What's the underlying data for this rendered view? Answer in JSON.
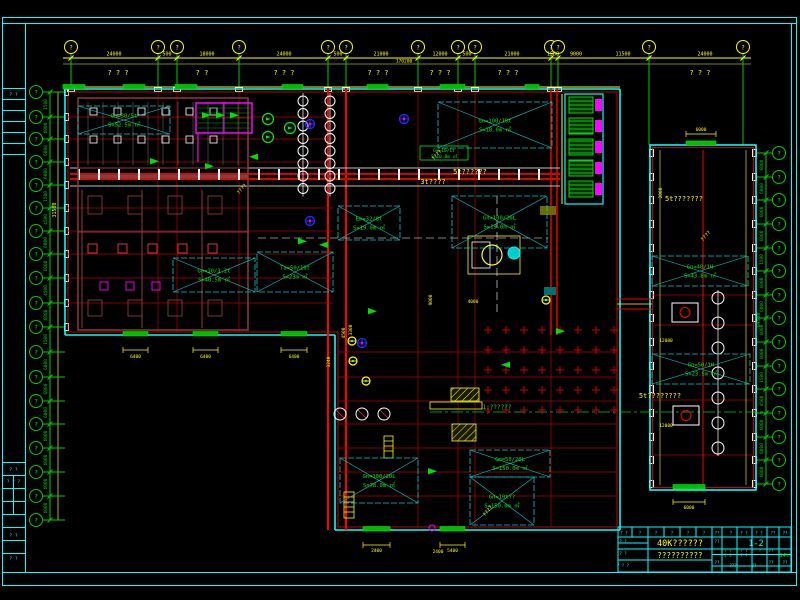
{
  "drawing": {
    "colors": {
      "frame": "#00FFFF",
      "grid_bubble": "#00CC00",
      "dim": "#FFFF00",
      "wall": "#00FFFF",
      "grid_line": "#B00000",
      "axis_green": "#00CC00",
      "equipment_maroon": "#8A3B3B",
      "stair": "#FF00FF",
      "door": "#00BB00",
      "label_green": "#00EE00",
      "label_yellow": "#FFFF00",
      "machine_white": "#FFFFFF",
      "pump_blue": "#2A2AFF"
    },
    "top_axis": {
      "bubble_label": "?",
      "bubbles": [
        {
          "x": 71
        },
        {
          "x": 158
        },
        {
          "x": 177
        },
        {
          "x": 239
        },
        {
          "x": 328
        },
        {
          "x": 346
        },
        {
          "x": 418
        },
        {
          "x": 458
        },
        {
          "x": 475
        },
        {
          "x": 551
        },
        {
          "x": 558
        },
        {
          "x": 649,
          "drop": 145
        },
        {
          "x": 743,
          "drop": 145
        }
      ],
      "dims": [
        {
          "x": 114,
          "t": "24000"
        },
        {
          "x": 167,
          "t": "500"
        },
        {
          "x": 207,
          "t": "18000"
        },
        {
          "x": 284,
          "t": "24000"
        },
        {
          "x": 338,
          "t": "500"
        },
        {
          "x": 381,
          "t": "21000"
        },
        {
          "x": 440,
          "t": "12000"
        },
        {
          "x": 467,
          "t": "500"
        },
        {
          "x": 512,
          "t": "21000"
        },
        {
          "x": 553,
          "t": "1500"
        },
        {
          "x": 576,
          "t": "9000"
        },
        {
          "x": 623,
          "t": "11500"
        },
        {
          "x": 705,
          "t": "24000"
        }
      ],
      "total": {
        "x": 404,
        "t": "170200"
      },
      "notes": [
        {
          "x": 118,
          "t": "? ? ?"
        },
        {
          "x": 202,
          "t": "?  ?"
        },
        {
          "x": 284,
          "t": "? ? ?"
        },
        {
          "x": 378,
          "t": "? ? ?"
        },
        {
          "x": 440,
          "t": "? ? ?"
        },
        {
          "x": 508,
          "t": "? ? ?"
        },
        {
          "x": 700,
          "t": "? ? ?"
        }
      ]
    },
    "left_axis": {
      "bubble_label": "?",
      "ys": [
        92,
        117,
        139,
        162,
        185,
        208,
        231,
        254,
        278,
        303,
        327,
        352,
        377,
        401,
        424,
        448,
        472,
        496,
        520
      ],
      "dims": [
        "1500",
        "6000",
        "6000",
        "6000",
        "1500",
        "4500",
        "6000",
        "6000",
        "4500",
        "6000",
        "1500",
        "6000",
        "6000",
        "6000",
        "6000",
        "6000",
        "6000",
        "6000"
      ],
      "aux_total": {
        "y": 210,
        "t": "31500"
      }
    },
    "right_axis": {
      "bubble_label": "?",
      "ys": [
        153,
        177,
        200,
        224,
        248,
        271,
        295,
        318,
        342,
        366,
        389,
        413,
        437,
        460,
        484
      ],
      "dims": [
        "6000",
        "6000",
        "6000",
        "6000",
        "1500",
        "6000",
        "6000",
        "6000",
        "6000",
        "1500",
        "4500",
        "6000",
        "6000",
        "6000"
      ],
      "total": {
        "y": 320,
        "t": "64500"
      }
    },
    "rooms": [
      {
        "x": 78,
        "y": 106,
        "w": 92,
        "h": 28,
        "l1": "Gn=30/5t",
        "l2": "S=52.5m ㎡"
      },
      {
        "x": 173,
        "y": 258,
        "w": 82,
        "h": 34,
        "l1": "Gn=10/3.2t",
        "l2": "S=40.5m ㎡"
      },
      {
        "x": 257,
        "y": 252,
        "w": 76,
        "h": 40,
        "l1": "Ta=50/10t",
        "l2": "S=23m ㎡"
      },
      {
        "x": 338,
        "y": 206,
        "w": 62,
        "h": 34,
        "l1": "Em=32/8t",
        "l2": "S=19.0m ㎡"
      },
      {
        "x": 438,
        "y": 102,
        "w": 114,
        "h": 46,
        "l1": "Gn=100/10t",
        "l2": "S=18.0m ㎡"
      },
      {
        "x": 452,
        "y": 196,
        "w": 95,
        "h": 52,
        "l1": "Gn=100/20L",
        "l2": "S=19.0m ㎡"
      },
      {
        "x": 340,
        "y": 458,
        "w": 78,
        "h": 45,
        "l1": "Gn=100/20L",
        "l2": "S=78.0m ㎡"
      },
      {
        "x": 470,
        "y": 450,
        "w": 80,
        "h": 27,
        "l1": "Gm=50/20L",
        "l2": "S=150.0m ㎡"
      },
      {
        "x": 470,
        "y": 477,
        "w": 64,
        "h": 48,
        "l1": "Gn=10t??",
        "l2": "S=150.0m ㎡"
      },
      {
        "x": 652,
        "y": 256,
        "w": 96,
        "h": 30,
        "l1": "Gn=40/1H",
        "l2": "S=43.8m ㎡"
      },
      {
        "x": 652,
        "y": 354,
        "w": 98,
        "h": 30,
        "l1": "Gn=50/1H",
        "l2": "S=23.5m ㎡"
      }
    ],
    "doors": [
      {
        "x": 63,
        "y": 84.5,
        "w": 22,
        "h": 4.5
      },
      {
        "x": 123,
        "y": 84.5,
        "w": 22,
        "h": 4.5
      },
      {
        "x": 175,
        "y": 84.5,
        "w": 22,
        "h": 4.5
      },
      {
        "x": 282,
        "y": 84.5,
        "w": 21,
        "h": 4.5
      },
      {
        "x": 367,
        "y": 84.5,
        "w": 21,
        "h": 4.5
      },
      {
        "x": 440,
        "y": 84.5,
        "w": 25,
        "h": 4.5
      },
      {
        "x": 525,
        "y": 84.5,
        "w": 14,
        "h": 4.5
      },
      {
        "x": 123,
        "y": 331.5,
        "w": 25,
        "h": 4.5,
        "dim": {
          "t": "6400",
          "ly": 350,
          "ty": 358
        }
      },
      {
        "x": 193,
        "y": 331.5,
        "w": 25,
        "h": 4.5,
        "dim": {
          "t": "6400",
          "ly": 350,
          "ty": 358
        }
      },
      {
        "x": 281,
        "y": 331.5,
        "w": 26,
        "h": 4.5,
        "dim": {
          "t": "6400",
          "ly": 350,
          "ty": 358
        }
      },
      {
        "x": 363,
        "y": 526.5,
        "w": 27,
        "h": 4.5,
        "dim": {
          "t": "2400",
          "ly": 545,
          "ty": 552
        }
      },
      {
        "x": 440,
        "y": 526.5,
        "w": 25,
        "h": 4.5,
        "dim": {
          "t": "5400",
          "ly": 545,
          "ty": 552
        }
      },
      {
        "x": 686,
        "y": 141,
        "w": 30,
        "h": 4.5,
        "dim": {
          "t": "6000",
          "ly": 134,
          "ty": 131
        }
      },
      {
        "x": 673,
        "y": 484.5,
        "w": 32,
        "h": 4.5,
        "dim": {
          "t": "6000",
          "ly": 502,
          "ty": 509
        }
      }
    ],
    "labels": [
      {
        "x": 433,
        "y": 184,
        "t": "3t????",
        "c": "#FFFF00",
        "s": 7
      },
      {
        "x": 470,
        "y": 174,
        "t": "5t??????",
        "c": "#FFFF00",
        "s": 7
      },
      {
        "x": 684,
        "y": 201,
        "t": "5t???????",
        "c": "#FFFF00",
        "s": 7
      },
      {
        "x": 660,
        "y": 398,
        "t": "5t????????",
        "c": "#FFFF00",
        "s": 7
      },
      {
        "x": 497,
        "y": 409,
        "t": "1:??????",
        "c": "#00EE00",
        "s": 6
      },
      {
        "x": 444,
        "y": 152,
        "t": "Gm=10/1t",
        "c": "#00EE00",
        "s": 4.5
      },
      {
        "x": 444,
        "y": 158,
        "t": "S=10.0m ㎡",
        "c": "#00EE00",
        "s": 4.5
      },
      {
        "x": 243,
        "y": 190,
        "t": "????",
        "c": "#FFFF00",
        "s": 5,
        "r": -50
      },
      {
        "x": 438,
        "y": 156,
        "t": "????",
        "c": "#FFFF00",
        "s": 5,
        "r": -50
      },
      {
        "x": 707,
        "y": 237,
        "t": "????",
        "c": "#FFFF00",
        "s": 5,
        "r": -50
      },
      {
        "x": 489,
        "y": 512,
        "t": "????",
        "c": "#FFFF00",
        "s": 5,
        "r": -50
      },
      {
        "x": 662,
        "y": 193,
        "t": "2000",
        "c": "#FFFF00",
        "s": 4.5,
        "r": -90
      },
      {
        "x": 666,
        "y": 342,
        "t": "12000",
        "c": "#FFFF00",
        "s": 4.5
      },
      {
        "x": 666,
        "y": 427,
        "t": "12000",
        "c": "#FFFF00",
        "s": 4.5
      },
      {
        "x": 352,
        "y": 330,
        "t": "3300",
        "c": "#FFFF00",
        "s": 4.5,
        "r": -90
      },
      {
        "x": 432,
        "y": 300,
        "t": "9000",
        "c": "#FFFF00",
        "s": 4.5,
        "r": -90
      },
      {
        "x": 345,
        "y": 333,
        "t": "4500",
        "c": "#FFFF00",
        "s": 4.5,
        "r": -90
      },
      {
        "x": 330,
        "y": 362,
        "t": "3240",
        "c": "#FFFF00",
        "s": 4.5,
        "r": -90
      },
      {
        "x": 473,
        "y": 303,
        "t": "4000",
        "c": "#FFFF00",
        "s": 4.5
      },
      {
        "x": 438,
        "y": 553,
        "t": "2400",
        "c": "#FFFF00",
        "s": 4.5
      }
    ],
    "plus_grid": {
      "x0": 488,
      "y0": 330,
      "dx": 18,
      "dy": 20,
      "cols": 8,
      "rows": 5
    },
    "conveyor": {
      "x0": 78,
      "x1": 556,
      "step": 20,
      "y": 169
    },
    "machine_trains": [
      {
        "x": 303,
        "y0": 101,
        "n": 8,
        "dy": 12.5,
        "r": 5
      },
      {
        "x": 330,
        "y0": 101,
        "n": 8,
        "dy": 12.5,
        "r": 5
      },
      {
        "x": 718,
        "y0": 298,
        "n": 7,
        "dy": 25,
        "r": 6
      }
    ],
    "box_rows": [
      {
        "x0": 90,
        "y": 108,
        "n": 6,
        "dx": 24,
        "w": 7,
        "h": 7,
        "c": "#E8E8E8"
      },
      {
        "x0": 90,
        "y": 136,
        "n": 6,
        "dx": 24,
        "w": 7,
        "h": 7,
        "c": "#E8E8E8"
      },
      {
        "x0": 88,
        "y": 196,
        "n": 4,
        "dx": 40,
        "w": 14,
        "h": 18,
        "c": "#8A3B3B"
      },
      {
        "x0": 88,
        "y": 244,
        "n": 5,
        "dx": 30,
        "w": 9,
        "h": 9,
        "c": "#FF3333"
      },
      {
        "x0": 100,
        "y": 282,
        "n": 3,
        "dx": 26,
        "w": 8,
        "h": 8,
        "c": "#FF00FF"
      },
      {
        "x0": 88,
        "y": 300,
        "n": 4,
        "dx": 40,
        "w": 14,
        "h": 16,
        "c": "#8A3B3B"
      }
    ],
    "small_grid": {
      "x0": 88,
      "x1": 238,
      "step": 15,
      "y0": 102,
      "y1": 165
    },
    "arrows": [
      [
        202,
        112,
        0
      ],
      [
        216,
        112,
        0
      ],
      [
        230,
        112,
        0
      ],
      [
        150,
        158,
        0
      ],
      [
        205,
        163,
        0
      ],
      [
        258,
        160,
        180
      ],
      [
        298,
        238,
        0
      ],
      [
        328,
        248,
        180
      ],
      [
        368,
        308,
        0
      ],
      [
        510,
        368,
        180
      ],
      [
        556,
        328,
        0
      ],
      [
        428,
        468,
        0
      ]
    ],
    "pumps_blue": [
      [
        310,
        124
      ],
      [
        310,
        221
      ],
      [
        404,
        119
      ],
      [
        362,
        343
      ]
    ],
    "pumps_yellow": [
      [
        352,
        341
      ],
      [
        353,
        361
      ],
      [
        366,
        381
      ],
      [
        546,
        300
      ]
    ],
    "pumps_green": [
      [
        268,
        119
      ],
      [
        268,
        137
      ],
      [
        290,
        128
      ]
    ],
    "frame_strip_cells": [
      {
        "y": 96,
        "t": "? ?"
      },
      {
        "y": 471,
        "t": "? ?"
      },
      {
        "y": 483,
        "t": "? ? ?"
      },
      {
        "y": 537,
        "t": "? ?"
      },
      {
        "y": 560,
        "t": "? ?"
      }
    ],
    "title_block": {
      "title": "40K??????",
      "subtitle": "??????????",
      "sheet_no": "1-2",
      "scale": "14%",
      "header_cells": [
        {
          "x": 624,
          "t": "? ?"
        },
        {
          "x": 640,
          "t": "?"
        },
        {
          "x": 656,
          "t": "?"
        },
        {
          "x": 672,
          "t": "?"
        },
        {
          "x": 688,
          "t": "?"
        },
        {
          "x": 704,
          "t": "?"
        },
        {
          "x": 717,
          "t": "??"
        },
        {
          "x": 731,
          "t": "?"
        },
        {
          "x": 744,
          "t": "? ?"
        },
        {
          "x": 759,
          "t": "? ?"
        },
        {
          "x": 773,
          "t": "??"
        },
        {
          "x": 785,
          "t": "??"
        }
      ],
      "cells": [
        {
          "x": 623,
          "y": 543,
          "t": "? ?",
          "c": "#00FFFF"
        },
        {
          "x": 623,
          "y": 555,
          "t": "? ?",
          "c": "#00FFFF"
        },
        {
          "x": 623,
          "y": 567,
          "t": "? ? ?",
          "c": "#00FFFF"
        },
        {
          "x": 717,
          "y": 543,
          "t": "??",
          "c": "#00FFFF"
        },
        {
          "x": 728,
          "y": 552,
          "t": "? ?",
          "c": "#00EE00"
        },
        {
          "x": 744,
          "y": 552,
          "t": "? ?",
          "c": "#00FFFF"
        },
        {
          "x": 760,
          "y": 552,
          "t": "?",
          "c": "#00FFFF"
        },
        {
          "x": 771,
          "y": 552,
          "t": "??",
          "c": "#00FFFF"
        },
        {
          "x": 728,
          "y": 557,
          "t": "2 3",
          "c": "#00EE00"
        },
        {
          "x": 744,
          "y": 557,
          "t": "? ?",
          "c": "#00FFFF"
        },
        {
          "x": 717,
          "y": 564,
          "t": "??",
          "c": "#00FFFF"
        },
        {
          "x": 733,
          "y": 567,
          "t": "???",
          "c": "#00FFFF"
        },
        {
          "x": 754,
          "y": 567,
          "t": "??",
          "c": "#00FFFF"
        },
        {
          "x": 771,
          "y": 564,
          "t": "??",
          "c": "#00FFFF"
        },
        {
          "x": 785,
          "y": 564,
          "t": "??",
          "c": "#00FFFF"
        }
      ]
    }
  }
}
